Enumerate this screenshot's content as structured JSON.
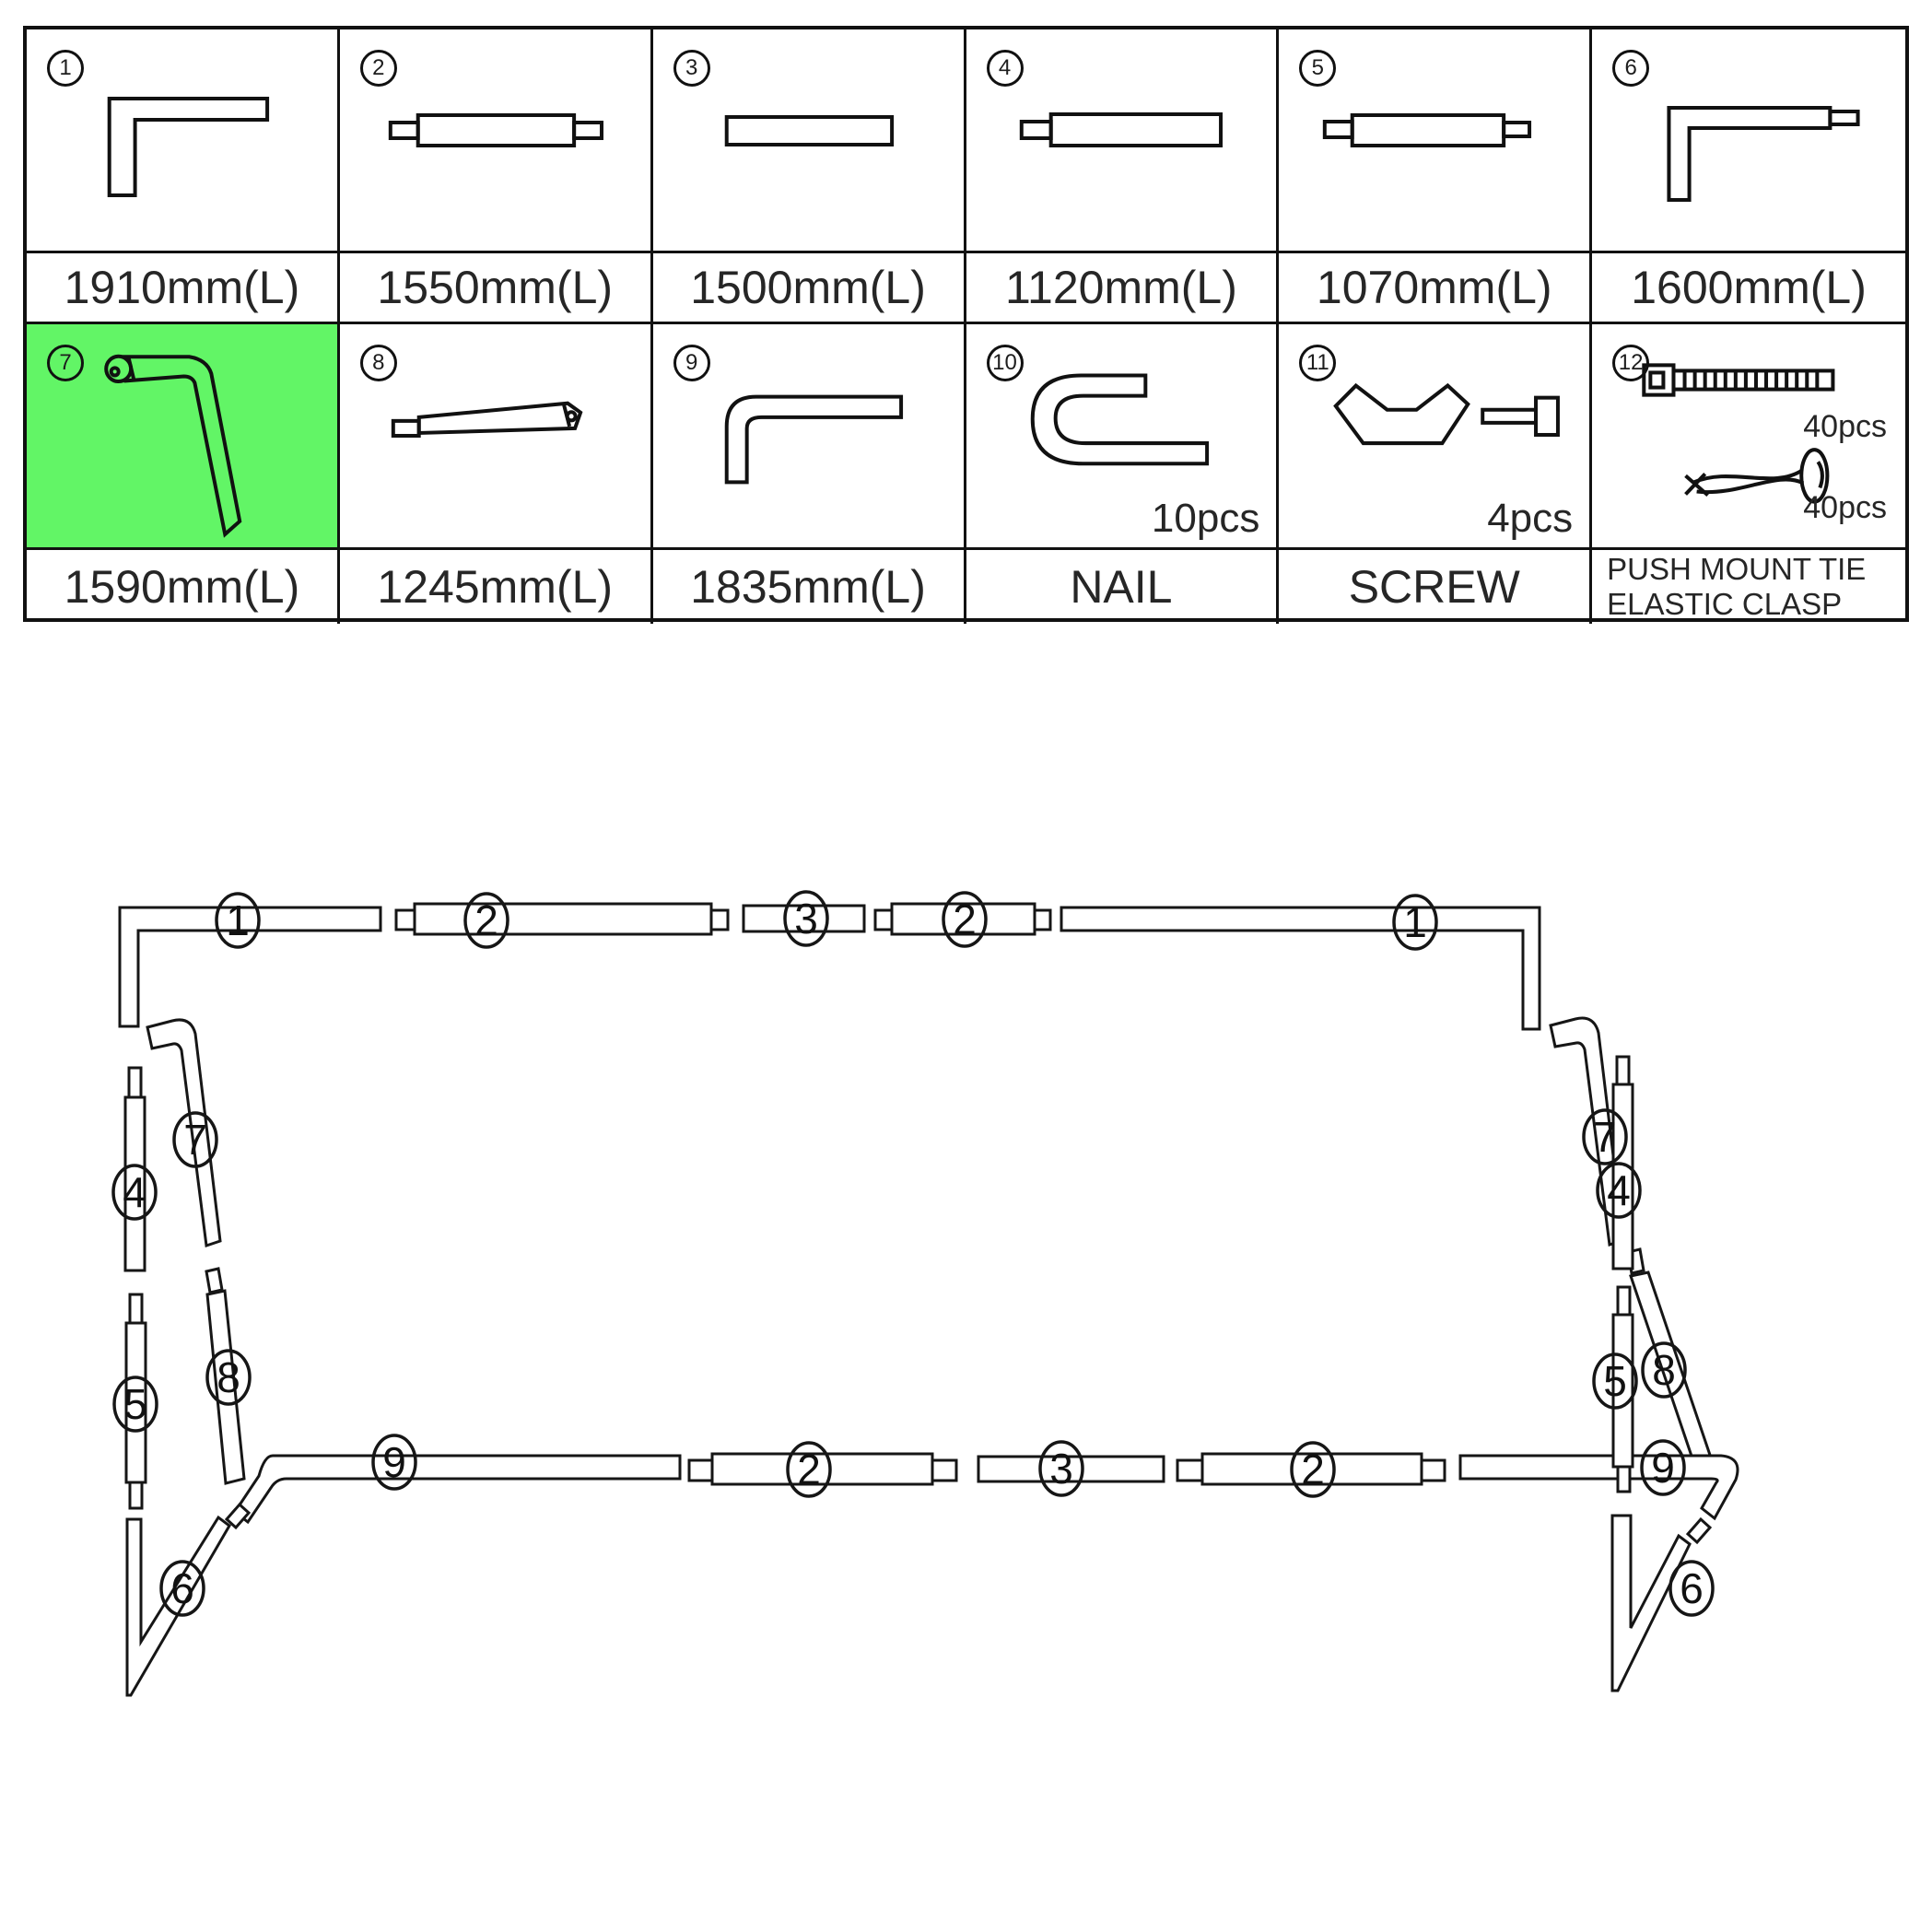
{
  "table": {
    "highlight_color": "#62f566",
    "row1": [
      {
        "num": "1",
        "label": "1910mm(L)"
      },
      {
        "num": "2",
        "label": "1550mm(L)"
      },
      {
        "num": "3",
        "label": "1500mm(L)"
      },
      {
        "num": "4",
        "label": "1120mm(L)"
      },
      {
        "num": "5",
        "label": "1070mm(L)"
      },
      {
        "num": "6",
        "label": "1600mm(L)"
      }
    ],
    "row2": [
      {
        "num": "7",
        "label": "1590mm(L)"
      },
      {
        "num": "8",
        "label": "1245mm(L)"
      },
      {
        "num": "9",
        "label": "1835mm(L)"
      },
      {
        "num": "10",
        "label": "NAIL",
        "qty": "10pcs"
      },
      {
        "num": "11",
        "label": "SCREW",
        "qty": "4pcs"
      },
      {
        "num": "12",
        "label_line1": "PUSH MOUNT TIE",
        "label_line2": "ELASTIC CLASP",
        "qty_tie": "40pcs",
        "qty_clasp": "40pcs"
      }
    ]
  },
  "diagram": {
    "callouts": [
      "1",
      "2",
      "3",
      "2",
      "1",
      "7",
      "4",
      "5",
      "8",
      "6",
      "9",
      "2",
      "3",
      "2",
      "7",
      "4",
      "5",
      "8",
      "9",
      "6"
    ]
  }
}
